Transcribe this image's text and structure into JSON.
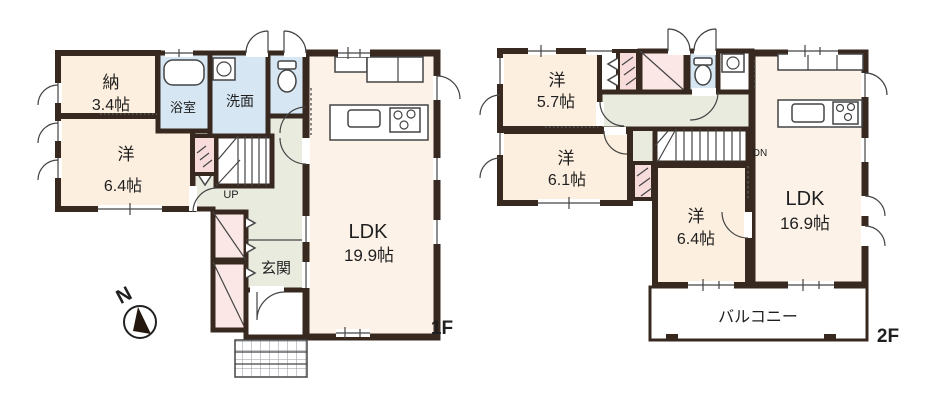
{
  "colors": {
    "wall": "#37291f",
    "room_cream": "#fcefdf",
    "room_ldk": "#fdf2e8",
    "wet_blue": "#d6e7f3",
    "closet_pink": "#fbe7e5",
    "hall_green": "#e9ebdf"
  },
  "compass": {
    "label": "N"
  },
  "floor1": {
    "floor_label": "1F",
    "storage": {
      "name": "納",
      "size": "3.4帖"
    },
    "bath": {
      "name": "浴室"
    },
    "washroom": {
      "name": "洗面"
    },
    "western": {
      "name": "洋",
      "size": "6.4帖"
    },
    "ldk": {
      "name": "LDK",
      "size": "19.9帖"
    },
    "entrance": {
      "name": "玄関"
    },
    "stairs_label": "UP"
  },
  "floor2": {
    "floor_label": "2F",
    "western1": {
      "name": "洋",
      "size": "5.7帖"
    },
    "western2": {
      "name": "洋",
      "size": "6.1帖"
    },
    "western3": {
      "name": "洋",
      "size": "6.4帖"
    },
    "ldk": {
      "name": "LDK",
      "size": "16.9帖"
    },
    "balcony": {
      "name": "バルコニー"
    },
    "stairs_label": "DN"
  }
}
